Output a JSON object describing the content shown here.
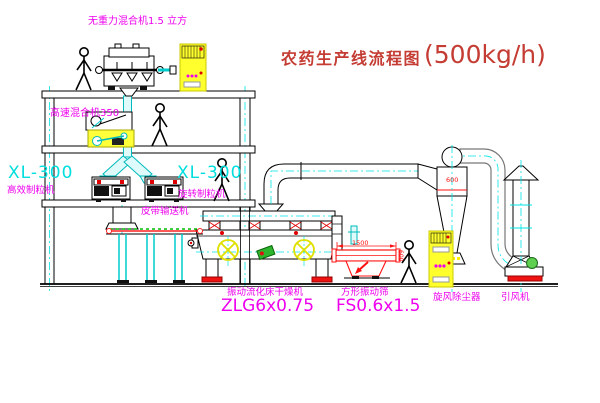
{
  "title": {
    "text": "农药生产线流程图",
    "capacity": "(500kg/h)"
  },
  "labels": {
    "gravity_mixer": "无重力混合机1.5 立方",
    "high_speed_mixer": "高速混合机350",
    "xl300_left": "XL-300",
    "granulator_left": "高效制粒机",
    "xl300_mid": "XL-300",
    "granulator_mid": "旋转制粒机",
    "belt_conveyor": "皮带输送机",
    "dryer": "振动流化床干燥机",
    "dryer_model": "ZLG6x0.75",
    "sieve": "方形振动筛",
    "sieve_model": "FS0.6x1.5",
    "cyclone": "旋风除尘器",
    "fan": "引风机"
  },
  "dimensions": {
    "sieve_length": "1500",
    "sieve_width": "600",
    "cyclone_diameter": "600"
  },
  "colors": {
    "label_magenta": "#ee00ee",
    "model_cyan": "#00dede",
    "title_red": "#c43c33",
    "dim_red": "#ff1111",
    "cabinet_yellow": "#ffff2e",
    "pipe_cyan": "#00c8c8",
    "conveyor_green": "#00bb00"
  }
}
